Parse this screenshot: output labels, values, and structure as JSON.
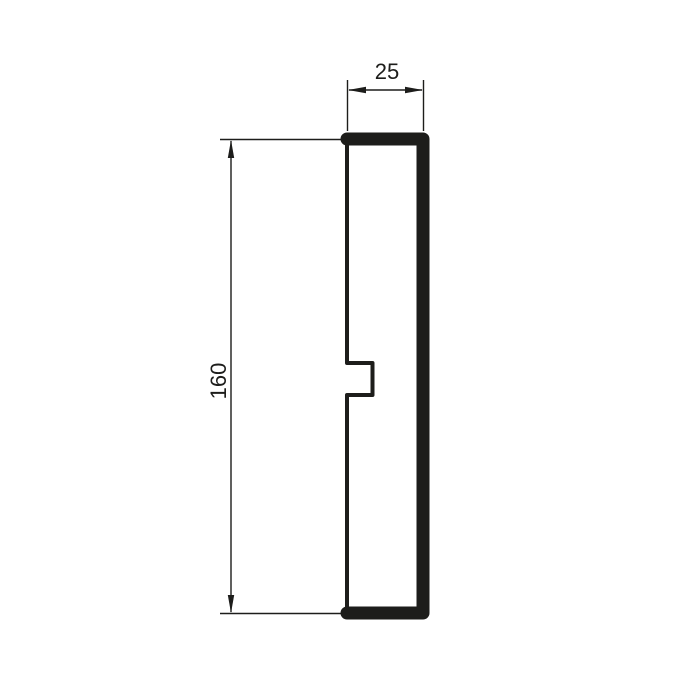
{
  "colors": {
    "line": "#1d1d1b",
    "background": "#ffffff"
  },
  "dimensions": {
    "width": {
      "label": "25"
    },
    "height": {
      "label": "160"
    }
  }
}
